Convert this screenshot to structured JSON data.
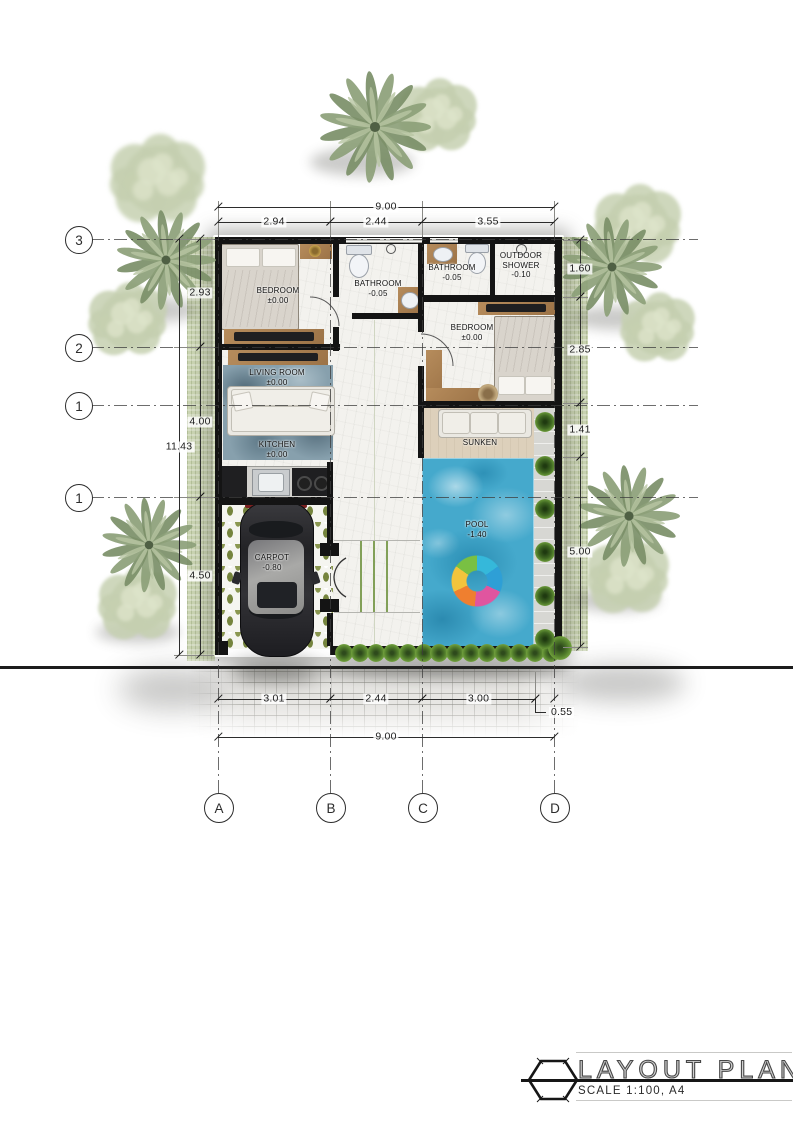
{
  "plan": {
    "rooms": [
      {
        "id": "bedroom-1",
        "name": "BEDROOM",
        "level": "±0.00"
      },
      {
        "id": "bathroom-1",
        "name": "BATHROOM",
        "level": "-0.05"
      },
      {
        "id": "bathroom-2",
        "name": "BATHROOM",
        "level": "-0.05"
      },
      {
        "id": "outdoor-shower",
        "name": "OUTDOOR SHOWER",
        "level": "-0.10"
      },
      {
        "id": "bedroom-2",
        "name": "BEDROOM",
        "level": "±0.00"
      },
      {
        "id": "living-room",
        "name": "LIVING ROOM",
        "level": "±0.00"
      },
      {
        "id": "kitchen",
        "name": "KITCHEN",
        "level": "±0.00"
      },
      {
        "id": "sunken",
        "name": "SUNKEN",
        "level": ""
      },
      {
        "id": "pool",
        "name": "POOL",
        "level": "-1.40"
      },
      {
        "id": "carport",
        "name": "CARPOT",
        "level": "-0.80"
      }
    ]
  },
  "dimensions": {
    "top": {
      "overall": "9.00",
      "segments": [
        "2.94",
        "2.44",
        "3.55"
      ]
    },
    "bottom": {
      "overall": "9.00",
      "segments": [
        "3.01",
        "2.44",
        "3.00"
      ],
      "offset": "0.55"
    },
    "left": {
      "overall": "11.43",
      "segments": [
        "2.93",
        "4.00",
        "4.50"
      ]
    },
    "right": {
      "segments": [
        "1.60",
        "2.85",
        "1.41",
        "5.00"
      ]
    }
  },
  "grid": {
    "row_labels": [
      "3",
      "2",
      "1",
      "1"
    ],
    "column_labels": [
      "A",
      "B",
      "C",
      "D"
    ]
  },
  "title_block": {
    "title": "LAYOUT PLAN",
    "scale": "SCALE 1:100,  A4"
  },
  "colors": {
    "wall": "#141414",
    "pool_water": "#45a9cc",
    "sunken_floor": "#ddd0bb",
    "carport_tile": "#75843d",
    "grass": "#cbd5b3",
    "hedge": "#4f7a2a",
    "paving": "#e7e6e3"
  }
}
